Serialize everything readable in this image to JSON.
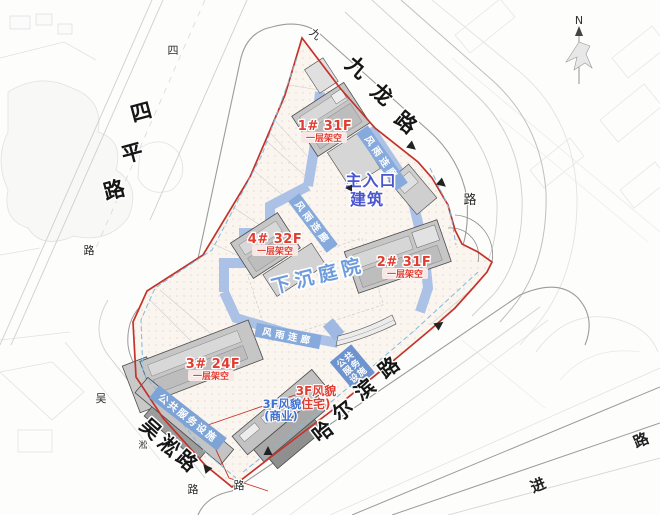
{
  "plan": {
    "buildings": {
      "b1": {
        "label": "1# 31F",
        "sub": "一层架空"
      },
      "b2": {
        "label": "2# 31F",
        "sub": "一层架空"
      },
      "b3": {
        "label": "3# 24F",
        "sub": "一层架空"
      },
      "b4": {
        "label": "4# 32F",
        "sub": "一层架空"
      }
    },
    "entrance": {
      "line1": "主入口",
      "line2": "建筑"
    },
    "courtyard": "下沉庭院",
    "corridor": "风雨连廊",
    "public_service": "公共服务设施",
    "public_service_lines": [
      "公共",
      "服务",
      "设施"
    ],
    "heritage_residential": {
      "line1": "3F风貌",
      "line2": "(住宅)"
    },
    "heritage_commercial": {
      "line1": "3F风貌",
      "line2": "(商业)"
    }
  },
  "roads": {
    "siping": {
      "chars": [
        "四",
        "平",
        "路"
      ],
      "small_chars": [
        "四",
        "路"
      ]
    },
    "jiulong": {
      "chars": [
        "九",
        "龙",
        "路"
      ],
      "small_chars": [
        "九",
        "路"
      ]
    },
    "haerbin": {
      "chars": [
        "哈",
        "尔",
        "滨",
        "路"
      ]
    },
    "wusong": {
      "chars": [
        "吴",
        "淞",
        "路"
      ],
      "small_chars": [
        "吴",
        "淞",
        "路",
        "路"
      ]
    },
    "jin": {
      "chars": [
        "进",
        "路"
      ]
    }
  },
  "compass": {
    "label": "N"
  },
  "colors": {
    "boundary": "#c4332b",
    "red_label": "#e23c30",
    "blue_label": "#4a56cf",
    "courtyard_blue": "#6e9bdc",
    "ribbon_blue": "#87aadd",
    "ps_box_blue": "#6d94cf",
    "corridor_blue": "#abc2e6",
    "building_gray": "#c6c6c6"
  }
}
